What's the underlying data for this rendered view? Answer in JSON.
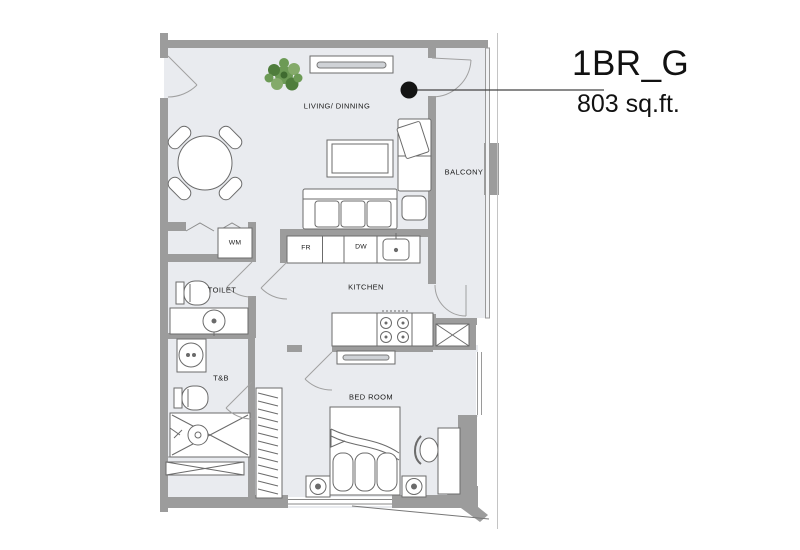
{
  "title": {
    "unit": "1BR_G",
    "area": "803 sq.ft."
  },
  "rooms": {
    "living": "LIVING/ DINNING",
    "balcony": "BALCONY",
    "kitchen": "KITCHEN",
    "toilet": "TOILET",
    "tb": "T&B",
    "bedroom": "BED ROOM"
  },
  "appliances": {
    "fridge": "FR",
    "dishwasher": "DW",
    "washing_machine": "WM"
  },
  "colors": {
    "wall": "#9c9c9c",
    "floor": "#e9ebef",
    "furniture_line": "#6b6b6b",
    "door_arc": "#a0a0a0",
    "plant_green": "#5f8f4a",
    "callout_dot": "#141414",
    "text": "#1a1a1a"
  }
}
